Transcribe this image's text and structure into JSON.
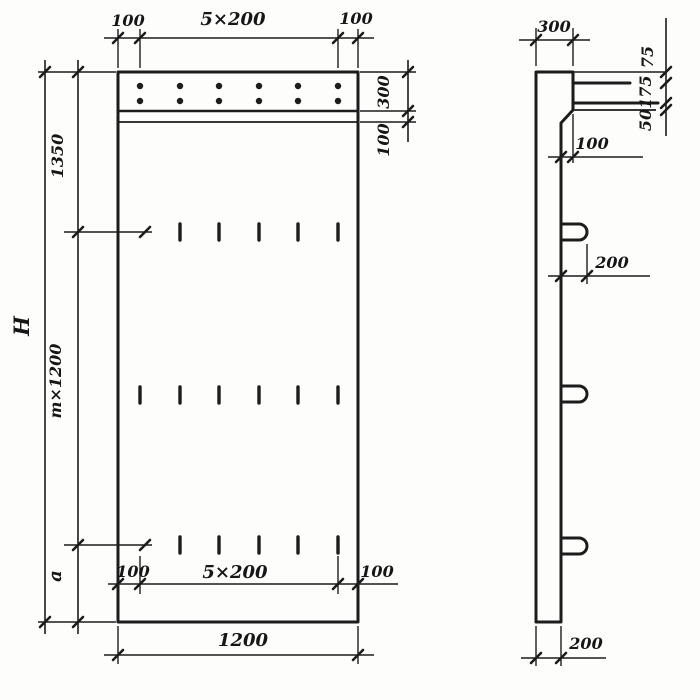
{
  "colors": {
    "ink": "#1c1c1c",
    "paper": "#fdfdfc"
  },
  "front_view": {
    "dim_top_left": "100",
    "dim_top_span": "5×200",
    "dim_top_right": "100",
    "dim_band_height": "300",
    "dim_band_gap": "100",
    "dim_height_total": "H",
    "dim_height_top": "1350",
    "dim_height_middle": "m×1200",
    "dim_height_bottom": "a",
    "dim_inner_left": "100",
    "dim_inner_span": "5×200",
    "dim_inner_right": "100",
    "dim_width_overall": "1200"
  },
  "side_view": {
    "dim_top_width": "300",
    "dim_cap_upper": "75",
    "dim_cap_middle": "175",
    "dim_cap_lower": "50",
    "dim_taper_offset": "100",
    "dim_hook_length": "200",
    "dim_bottom_thickness": "200"
  }
}
